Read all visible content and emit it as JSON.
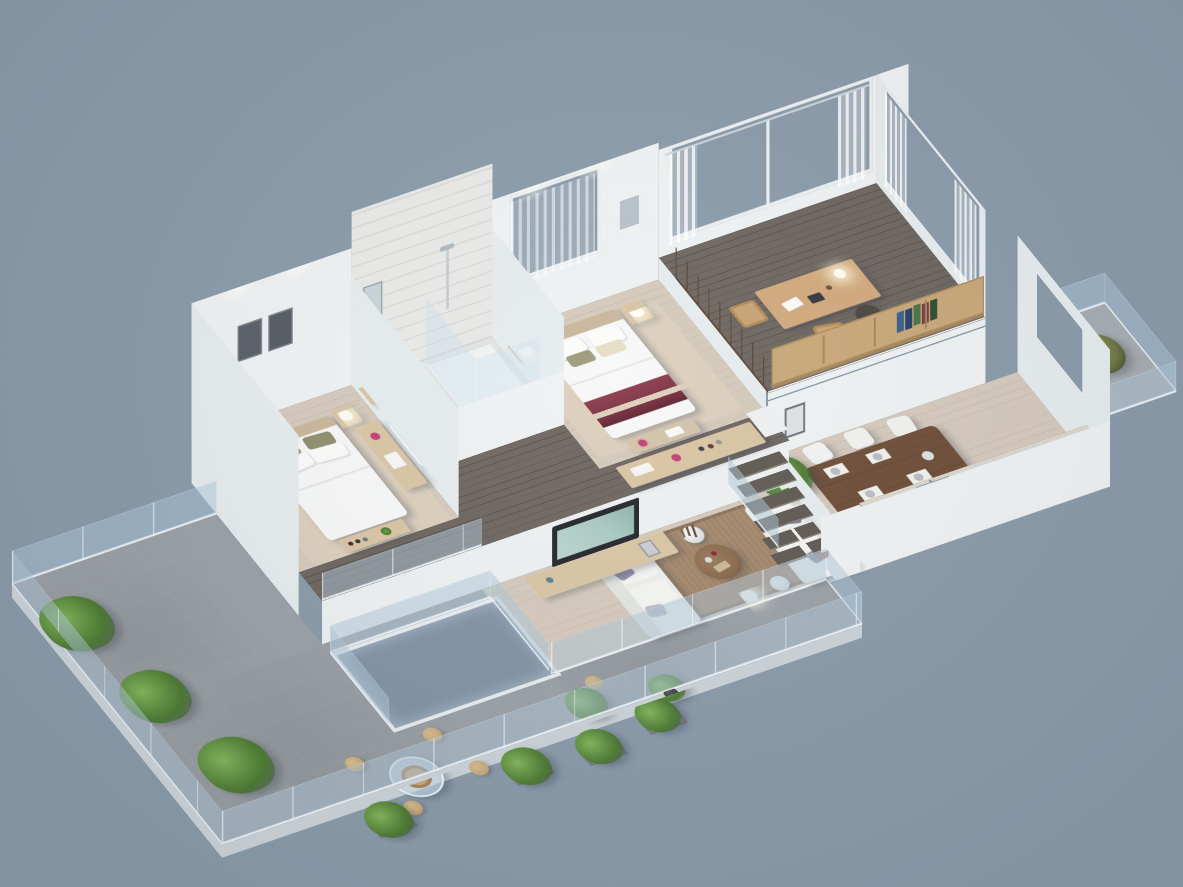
{
  "scene": {
    "kind": "3d-isometric-floor-plan-render",
    "description": "Photorealistic 3D cutaway isometric render of a split-level apartment on a plain blue-gray background; no text or UI elements visible.",
    "levels": [
      "upper platform: second bedroom, bathroom with glass shower, master bedroom, dark-wood hallway, study loft",
      "ground level: living room, dining area, kitchen, large tiled terrace, glass-covered light court, side balcony"
    ]
  },
  "palette": {
    "bg": "#8a9baa",
    "wall": "#f0f3f4",
    "wallshade": "#e7edef",
    "floorwood": "#d5cabc",
    "floorhall": "#6e6660",
    "floortile": "#9ba1a6",
    "tilebath": "#e4e5e3",
    "woodlight": "#d9c5a4",
    "counterwood": "#c49e6d",
    "tablewood": "#6f4e38",
    "deskwood": "#d2a97c",
    "maroon": "#7b3040",
    "olive": "#9c9b7a",
    "lavender": "#9191ac",
    "ruglive": "#a5896c",
    "rugbed": "#dccfbd",
    "green1": "#83b75c",
    "green2": "#4d7a33",
    "pot": "#3a3e42",
    "tvscreen": "#a9cac2",
    "bookshelf": "#c8a878",
    "glassrail": "#adc6d8",
    "flowerpink": "#c14078"
  },
  "rooms": {
    "master_bedroom": {
      "name": "master bedroom",
      "furniture": [
        "double bed with white duvet and maroon throw",
        "two nightstands with lit lamps",
        "storage bench with pink flowers",
        "beige rug",
        "hall sideboard with trays and flowers",
        "window with sheer curtains",
        "wall art frame"
      ]
    },
    "second_bedroom": {
      "name": "second bedroom",
      "furniture": [
        "double bed with olive pillows",
        "two nightstands with lit lamps",
        "foot console with bottles",
        "sideboard with pink flowers",
        "two dark wall frames",
        "ceiling downlights"
      ]
    },
    "bathroom": {
      "name": "bathroom",
      "furniture": [
        "corner glass shower with chrome fixture",
        "bathtub",
        "wood vanity with basin",
        "plank-tile walls"
      ]
    },
    "loft_study": {
      "name": "study loft",
      "furniture": [
        "wood desk with lamp and papers",
        "two wood chairs",
        "dark office chair",
        "bookshelf railing with books",
        "large windows with sheer curtains",
        "wood post railing",
        "dark plank floor"
      ]
    },
    "living_room": {
      "name": "living room",
      "furniture": [
        "two facing white sofas with lavender pillows",
        "round wood coffee table with bottles",
        "brown rug",
        "TV on wood media console",
        "tall white vase with dry branches",
        "glowing floor lamp",
        "white drum side table",
        "potted plant"
      ]
    },
    "dining_area": {
      "name": "dining area",
      "furniture": [
        "dark wood dining table",
        "six white chairs",
        "placemats and plates",
        "wall frame under loft"
      ]
    },
    "kitchen": {
      "name": "kitchen",
      "furniture": [
        "wood-front counter with stone top",
        "gas cooktop",
        "sink with faucet",
        "coffee maker",
        "kettle",
        "white end cabinet"
      ]
    },
    "terrace": {
      "name": "terrace",
      "furniture": [
        "glass railing with posts",
        "three potted palms",
        "round glass table with rattan base",
        "four rattan drum stools",
        "box planters with shrubs",
        "stone tile floor",
        "glass-covered light court"
      ]
    },
    "balcony": {
      "name": "side balcony",
      "furniture": [
        "glass railing",
        "potted plant"
      ]
    },
    "stairs": {
      "name": "staircase",
      "furniture": [
        "six dark wood treads",
        "glass balustrade",
        "white stringer wall"
      ]
    }
  }
}
